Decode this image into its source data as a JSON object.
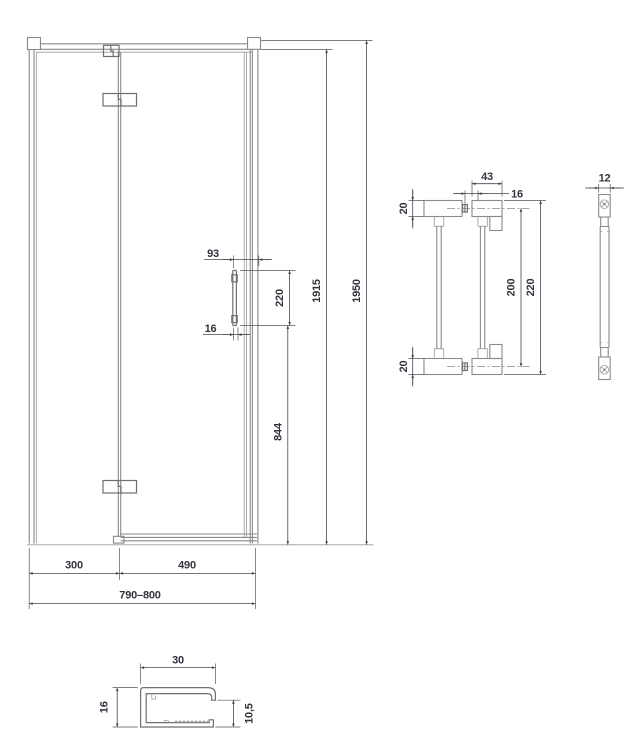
{
  "drawing": {
    "type": "technical-dimension-drawing",
    "subject": "pivot shower door with double-sided handle and bottom profile section",
    "colors": {
      "background": "#ffffff",
      "geometry_line": "#8a8a8e",
      "dimension_line": "#46464e",
      "text": "#33333e"
    }
  },
  "door_view": {
    "name": "door front view",
    "dims": {
      "total_width": "790–800",
      "fixed_width": "300",
      "door_width": "490",
      "glass_height": "1915",
      "total_height": "1950",
      "handle_bottom_offset": "844",
      "handle_length": "220",
      "handle_edge_offset": "93",
      "handle_hole_offset": "16"
    }
  },
  "handle_front_view": {
    "name": "handle front view",
    "dims": {
      "cap_width": "43",
      "screw_offset": "16",
      "cap_height_top": "20",
      "cap_height_bottom": "20",
      "screw_spacing": "200",
      "total_length": "220"
    }
  },
  "handle_side_view": {
    "name": "handle side view",
    "dims": {
      "thickness": "12"
    }
  },
  "profile_section": {
    "name": "bottom profile cross-section",
    "dims": {
      "width": "30",
      "height": "16",
      "inner_height": "10,5"
    }
  }
}
